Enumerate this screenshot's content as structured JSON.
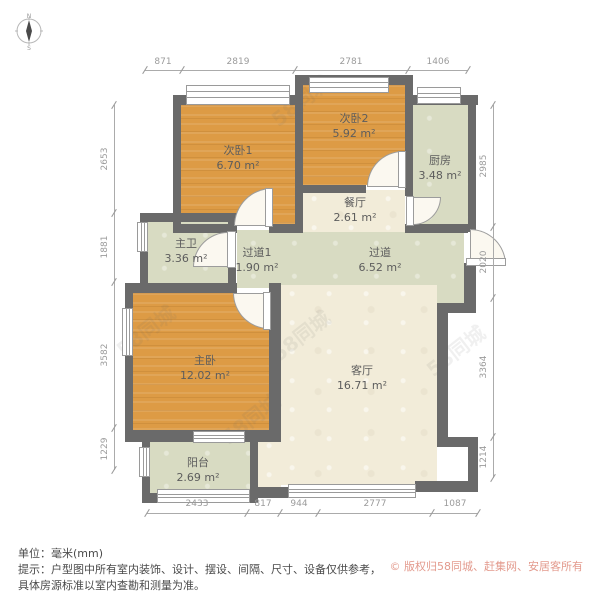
{
  "compass": {
    "north": "N",
    "south": "S"
  },
  "dims": {
    "top": [
      "871",
      "2819",
      "2781",
      "1406"
    ],
    "left": [
      "2653",
      "1881",
      "3582",
      "1229"
    ],
    "right": [
      "2985",
      "2020",
      "3364",
      "1214"
    ],
    "bottom": [
      "2433",
      "817",
      "944",
      "2777",
      "1087"
    ]
  },
  "rooms": [
    {
      "name": "次卧1",
      "area": "6.70 m²"
    },
    {
      "name": "次卧2",
      "area": "5.92 m²"
    },
    {
      "name": "厨房",
      "area": "3.48 m²"
    },
    {
      "name": "餐厅",
      "area": "2.61 m²"
    },
    {
      "name": "主卫",
      "area": "3.36 m²"
    },
    {
      "name": "过道1",
      "area": "1.90 m²"
    },
    {
      "name": "过道",
      "area": "6.52 m²"
    },
    {
      "name": "主卧",
      "area": "12.02 m²"
    },
    {
      "name": "客厅",
      "area": "16.71 m²"
    },
    {
      "name": "阳台",
      "area": "2.69 m²"
    }
  ],
  "watermark": {
    "text": "58同城"
  },
  "footer": {
    "unit": "单位：毫米(mm)",
    "tip1": "提示：户型图中所有室内装饰、设计、摆设、间隔、尺寸、设备仅供参考，",
    "tip2": "具体房源标准以室内查勘和测量为准。",
    "copyright": "© 版权归58同城、赶集网、安居客所有"
  },
  "colors": {
    "wall": "#6a6a6a",
    "bedroom_floor": "#dd9b45",
    "living_floor": "#f2ecd9",
    "utility_floor": "#d8dbc2",
    "dimension_text": "#9b9b9b",
    "copyright_text": "#e39a8d"
  }
}
